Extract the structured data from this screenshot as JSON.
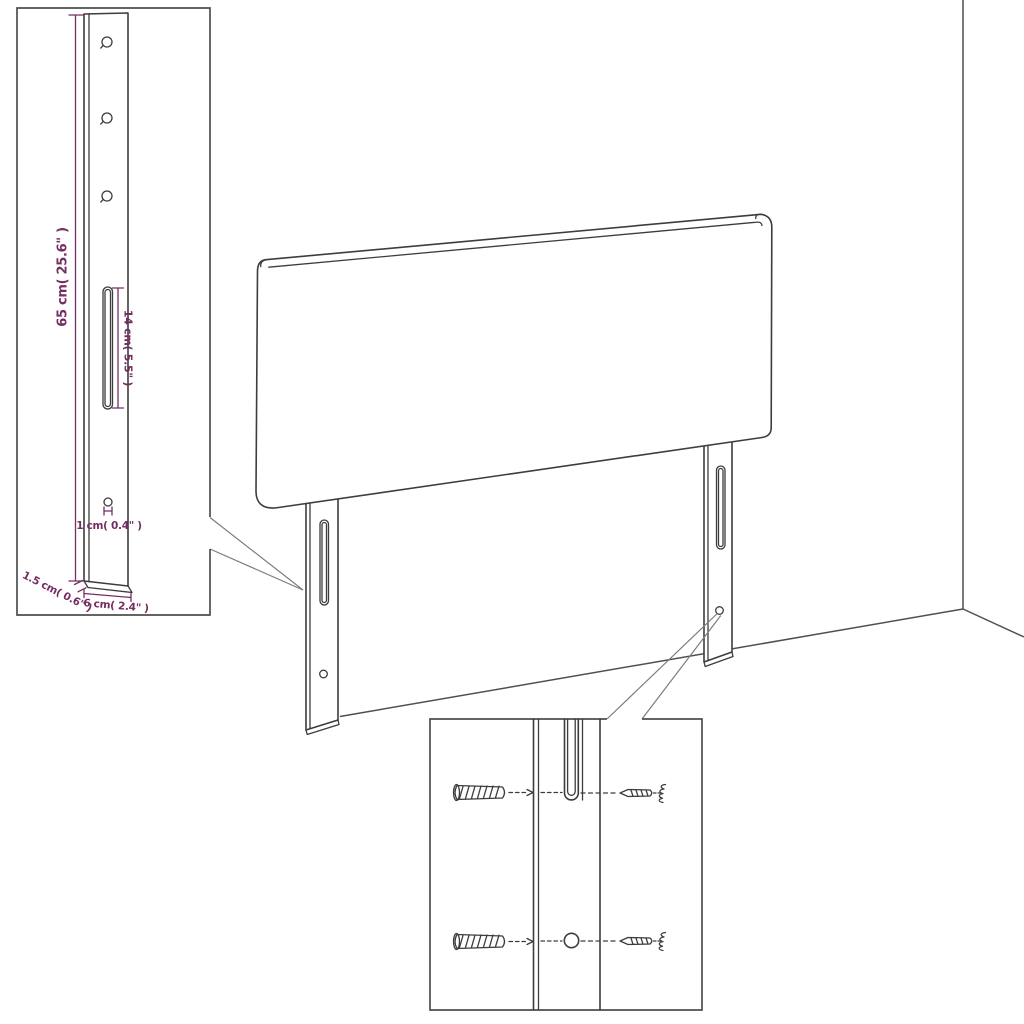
{
  "page": {
    "background": "#ffffff",
    "description": "Headboard assembly dimension diagram with zoom callouts"
  },
  "colors": {
    "outline": "#3d3d3d",
    "dimension": "#752e63",
    "frame": "#4f4f4f",
    "callout": "#7d7d7d",
    "background": "#ffffff"
  },
  "leg_detail_inset": {
    "height_label": "65 cm( 25.6\" )",
    "slot_label": "14 cm( 5.5\" )",
    "hole_label": "1 cm( 0.4\" )",
    "thickness_label": "1.5 cm( 0.6\" )",
    "width_label": "6 cm( 2.4\" )"
  },
  "hardware_inset": {
    "items": [
      "wall-plug",
      "screw",
      "mounting-slot",
      "mounting-hole"
    ]
  }
}
